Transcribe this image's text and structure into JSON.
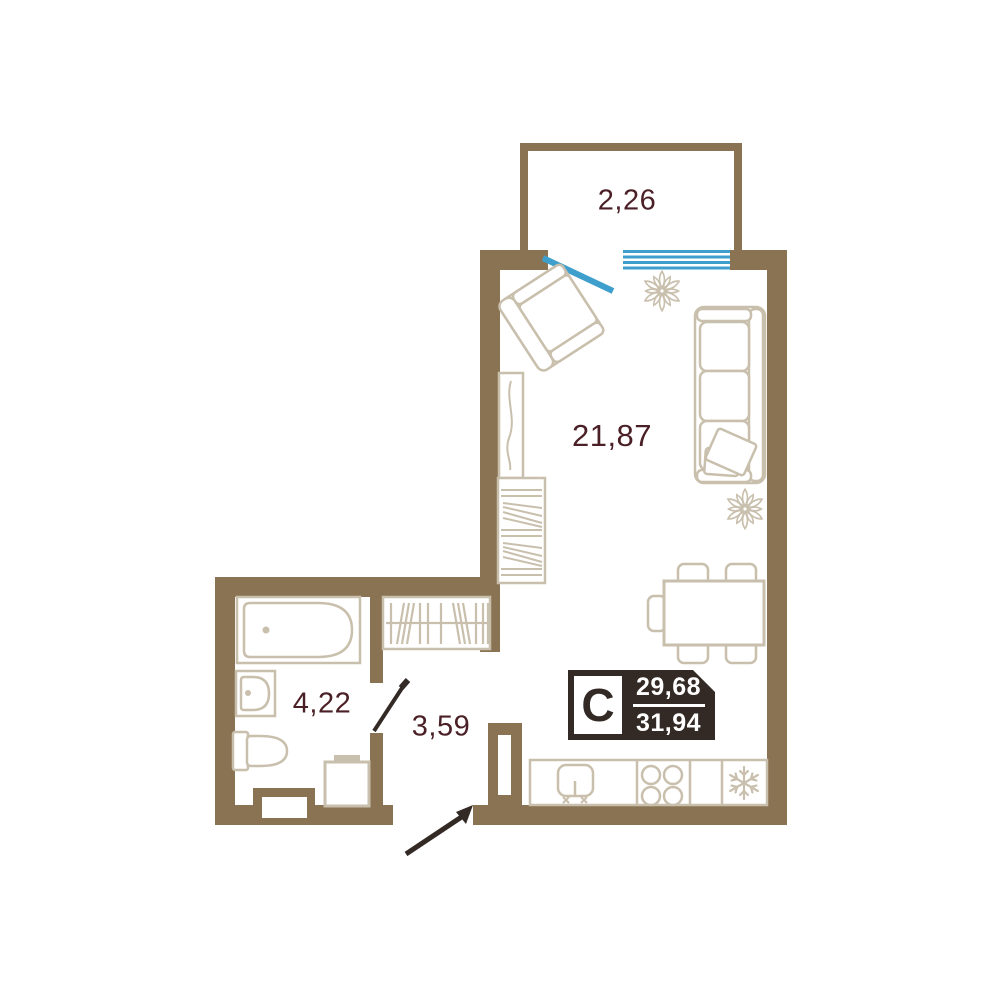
{
  "plan": {
    "type": "apartment-floor-plan",
    "rooms": {
      "balcony": {
        "area": "2,26"
      },
      "living": {
        "area": "21,87"
      },
      "bathroom": {
        "area": "4,22"
      },
      "hallway": {
        "area": "3,59"
      }
    },
    "badge": {
      "type_letter": "С",
      "upper_area": "29,68",
      "lower_area": "31,94"
    },
    "colors": {
      "wall": "#8a7352",
      "furniture_outline": "#c9bfad",
      "room_label": "#4a1f26",
      "window_blue": "#3e9fcc",
      "badge_bg": "#332a25",
      "door_leaf": "#332a25"
    },
    "icons": [
      "snowflake-icon",
      "stove-burners-icon",
      "kitchen-sink-icon",
      "plant-icon",
      "hanger-rack-icon"
    ]
  }
}
